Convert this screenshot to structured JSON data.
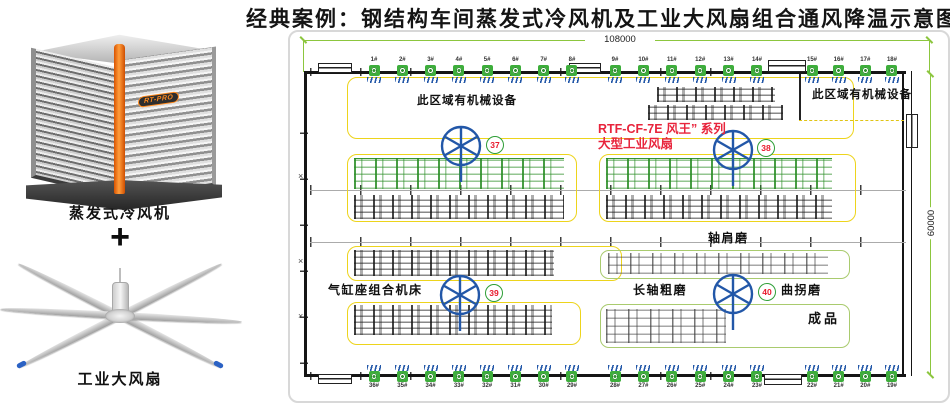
{
  "title": "经典案例：钢结构车间蒸发式冷风机及工业大风扇组合通风降温示意图",
  "left_panel": {
    "cooler_logo": "RT-PRO",
    "cooler_label": "蒸发式冷风机",
    "plus_sign": "+",
    "fan_label": "工业大风扇"
  },
  "plan": {
    "dim_top": "108000",
    "dim_right": "60000",
    "zone_label_left": "此区域有机械设备",
    "zone_label_right": "此区域有机械设备",
    "series_line1": "RTF-CF-7E 风王” 系列",
    "series_line2": "大型工业风扇",
    "label_shoulder_grinder": "轴肩磨",
    "label_cylinder_machine": "气缸座组合机床",
    "label_long_shaft": "长轴粗磨",
    "label_crank_grinder": "曲拐磨",
    "label_finished": "成品",
    "fan_nos": [
      "37",
      "38",
      "39",
      "40"
    ],
    "top_markers_g1": [
      "1#",
      "2#",
      "3#",
      "4#",
      "5#",
      "6#",
      "7#",
      "8#"
    ],
    "top_markers_g2": [
      "9#",
      "10#",
      "11#",
      "12#",
      "13#",
      "14#"
    ],
    "top_markers_g3": [
      "15#",
      "16#",
      "17#",
      "18#"
    ],
    "bottom_markers_g1": [
      "36#",
      "35#",
      "34#",
      "33#",
      "32#",
      "31#",
      "30#",
      "29#"
    ],
    "bottom_markers_g2": [
      "28#",
      "27#",
      "26#",
      "25#",
      "24#",
      "23#"
    ],
    "bottom_markers_g3": [
      "22#",
      "21#",
      "20#",
      "19#"
    ]
  },
  "colors": {
    "dim-green": "#8cc63e",
    "marker-green": "#3dae3b",
    "fan-blue": "#2257a8",
    "zone-yellow": "#edd41c",
    "zone-green": "#a9cb6e",
    "badge-ring": "#2e9e36",
    "badge-red": "#e8192c",
    "series-red": "#e8243c",
    "machine-green": "#2e8f2c",
    "accent-orange": "#f07818"
  }
}
